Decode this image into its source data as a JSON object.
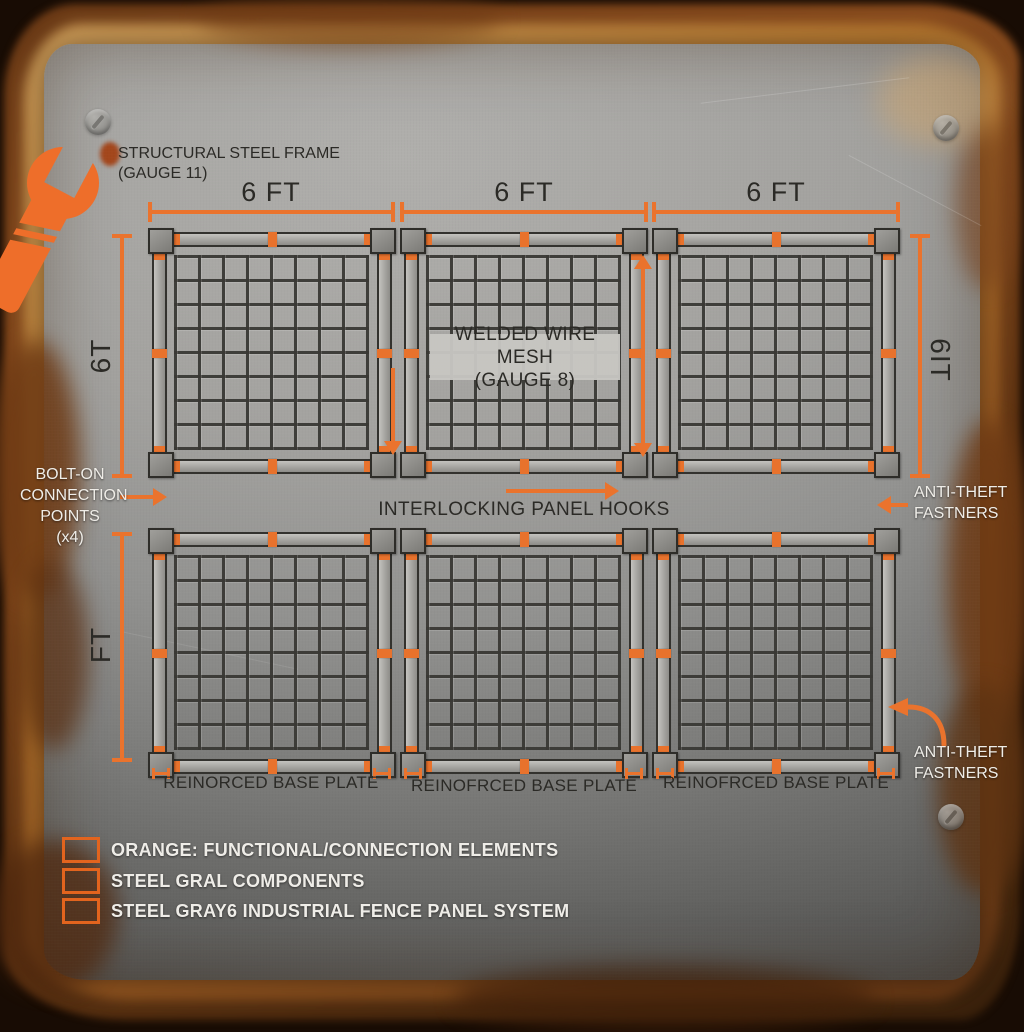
{
  "title": {
    "frame_note": "STRUCTURAL STEEL FRAME\n(GAUGE 11)"
  },
  "dimensions": {
    "top": [
      "6 FT",
      "6 FT",
      "6 FT"
    ],
    "left_upper": "6T",
    "left_lower": "FT",
    "right_upper": "6IT"
  },
  "callouts": {
    "bolt_on": "BOLT-ON\nCONNECTION\nPOINTS\n(x4)",
    "mesh_note": "WELDED WIRE MESH\n(GAUGE 8)",
    "interlocking": "INTERLOCKING PANEL HOOKS",
    "anti_theft_upper": "ANTI-THEFT\nFASTNERS",
    "anti_theft_lower": "ANTI-THEFT\nFASTNERS",
    "base_plates": [
      "REINORCED BASE PLATE",
      "REINOFRCED BASE PLATE",
      "REINOFRCED BASE PLATE"
    ]
  },
  "legend": {
    "items": [
      "ORANGE: FUNCTIONAL/CONNECTION ELEMENTS",
      "STEEL GRAL COMPONENTS",
      "STEEL GRAY6 INDUSTRIAL FENCE PANEL SYSTEM"
    ]
  },
  "colors": {
    "accent_orange": "#E8722C",
    "legend_border_orange": "#E2641E",
    "steel_plate_light": "#A9A8A5",
    "steel_plate_dark": "#504F4D",
    "rust_edge": "#7A431C",
    "text_dark": "#2B2A26",
    "text_light": "#EFEDE8"
  },
  "panel_grid": {
    "rows": 2,
    "cols": 3,
    "panel_count": 6,
    "mesh_cells": "8x8"
  }
}
